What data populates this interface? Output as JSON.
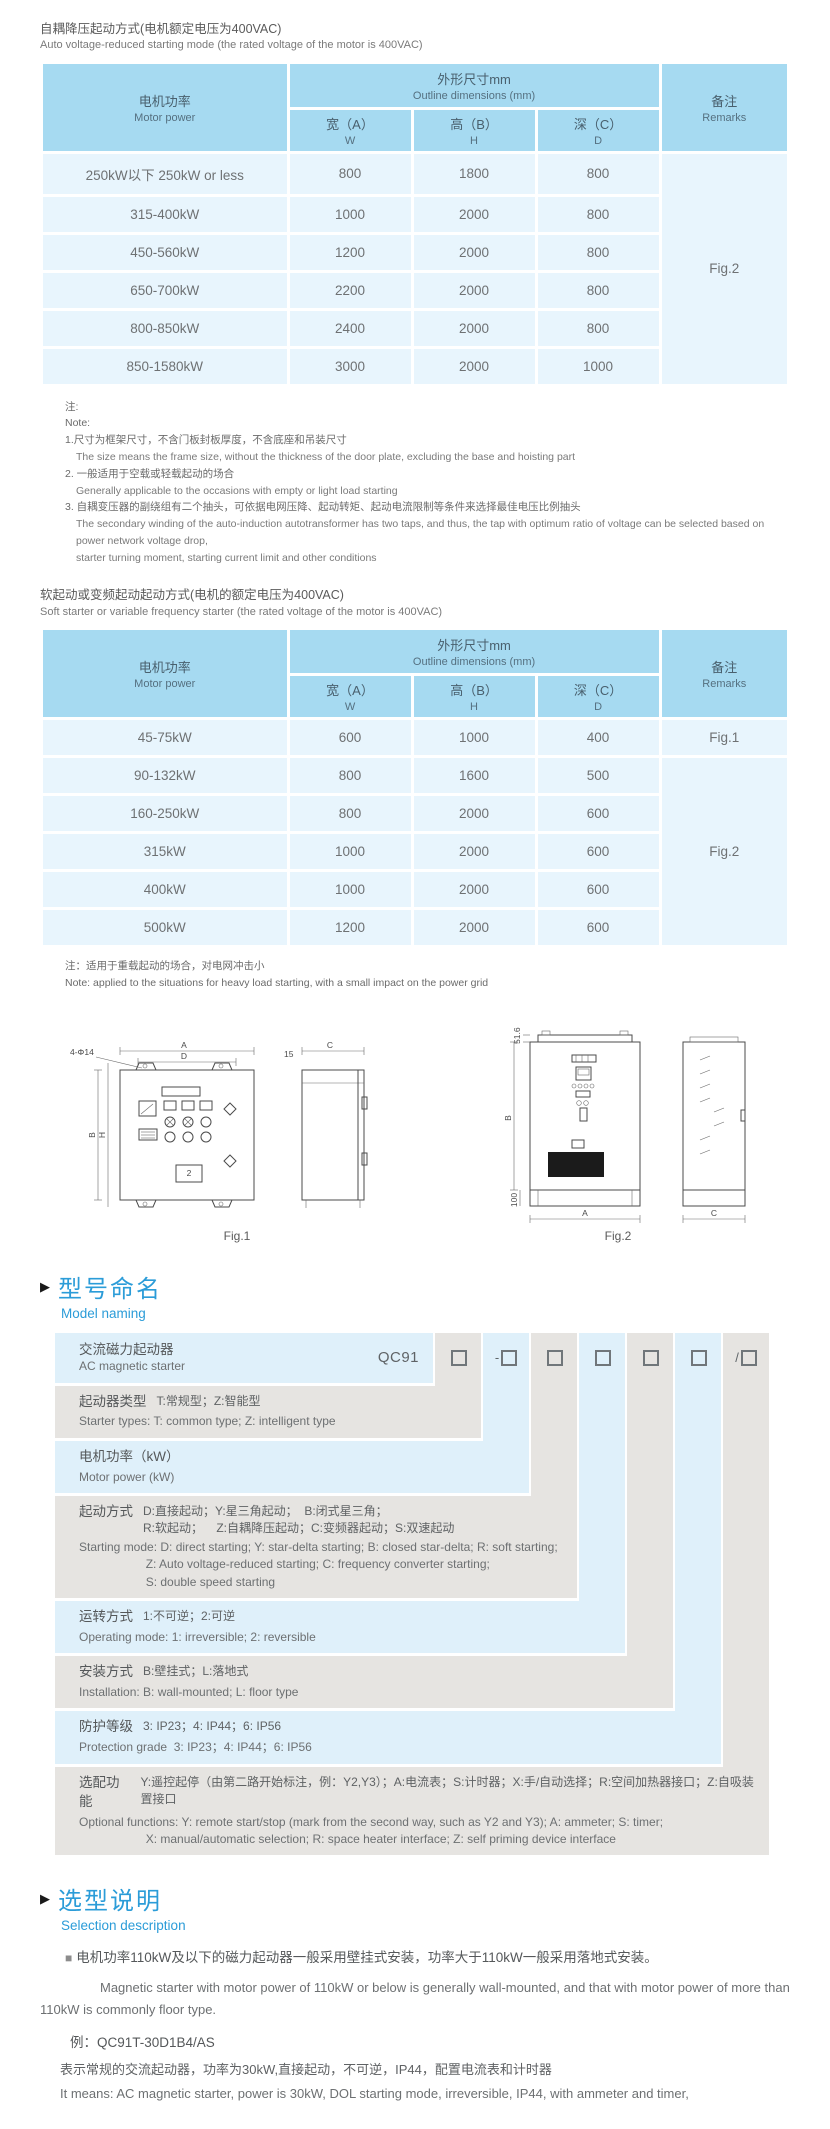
{
  "section1": {
    "title_zh": "自耦降压起动方式(电机额定电压为400VAC)",
    "title_en": "Auto voltage-reduced starting mode (the rated voltage of the motor is 400VAC)"
  },
  "dims_header": {
    "motor_zh": "电机功率",
    "motor_en": "Motor power",
    "outline_zh": "外形尺寸mm",
    "outline_en": "Outline dimensions (mm)",
    "w_zh": "宽（A）",
    "w_en": "W",
    "h_zh": "高（B）",
    "h_en": "H",
    "d_zh": "深（C）",
    "d_en": "D",
    "remarks_zh": "备注",
    "remarks_en": "Remarks"
  },
  "table1": {
    "rows": [
      {
        "power": "250kW以下 250kW or less",
        "w": "800",
        "h": "1800",
        "d": "800",
        "remark": "Fig.2",
        "remark_rowspan": 6
      },
      {
        "power": "315-400kW",
        "w": "1000",
        "h": "2000",
        "d": "800"
      },
      {
        "power": "450-560kW",
        "w": "1200",
        "h": "2000",
        "d": "800"
      },
      {
        "power": "650-700kW",
        "w": "2200",
        "h": "2000",
        "d": "800"
      },
      {
        "power": "800-850kW",
        "w": "2400",
        "h": "2000",
        "d": "800"
      },
      {
        "power": "850-1580kW",
        "w": "3000",
        "h": "2000",
        "d": "1000"
      }
    ]
  },
  "notes1": {
    "lines": [
      "注:",
      "Note:",
      "1.尺寸为框架尺寸，不含门板封板厚度，不含底座和吊装尺寸",
      "The size means the frame size, without the thickness of the door plate, excluding the base and hoisting part",
      "2. 一般适用于空载或轻载起动的场合",
      "Generally applicable to the occasions with empty or light load starting",
      "3. 自耦变压器的副绕组有二个抽头，可依据电网压降、起动转矩、起动电流限制等条件来选择最佳电压比例抽头",
      "The secondary winding of the auto-induction autotransformer has two taps, and thus, the tap with optimum ratio of voltage can be selected based on power network voltage drop,",
      "starter turning moment, starting current limit and other conditions"
    ]
  },
  "section2": {
    "title_zh": "软起动或变频起动起动方式(电机的额定电压为400VAC)",
    "title_en": "Soft starter or variable frequency starter (the rated voltage of the motor is 400VAC)"
  },
  "table2": {
    "rows": [
      {
        "power": "45-75kW",
        "w": "600",
        "h": "1000",
        "d": "400",
        "remark": "Fig.1",
        "remark_rowspan": 1
      },
      {
        "power": "90-132kW",
        "w": "800",
        "h": "1600",
        "d": "500",
        "remark": "Fig.2",
        "remark_rowspan": 5
      },
      {
        "power": "160-250kW",
        "w": "800",
        "h": "2000",
        "d": "600"
      },
      {
        "power": "315kW",
        "w": "1000",
        "h": "2000",
        "d": "600"
      },
      {
        "power": "400kW",
        "w": "1000",
        "h": "2000",
        "d": "600"
      },
      {
        "power": "500kW",
        "w": "1200",
        "h": "2000",
        "d": "600"
      }
    ]
  },
  "note2": {
    "zh": "注：适用于重载起动的场合，对电网冲击小",
    "en": "Note: applied to the situations for heavy load starting, with a small impact on the power grid"
  },
  "figures": {
    "fig1": {
      "label": "Fig.1",
      "labels": {
        "a": "A",
        "d": "D",
        "holes": "4-Φ14",
        "b": "B",
        "h": "H",
        "c": "C",
        "n15": "15",
        "panel2": "2"
      }
    },
    "fig2": {
      "label": "Fig.2",
      "labels": {
        "n516": "51.6",
        "b": "B",
        "n100": "100",
        "a": "A",
        "c": "C"
      }
    }
  },
  "model": {
    "arrow": "▶",
    "title_zh": "型号命名",
    "title_en": "Model naming",
    "starter_zh": "交流磁力起动器",
    "starter_en": "AC magnetic starter",
    "code": "QC91",
    "box_prefixes": [
      "",
      "-",
      "",
      "",
      "",
      "",
      "/"
    ],
    "rows": [
      {
        "zh_label": "起动器类型",
        "zh_desc": "T:常规型；Z:智能型",
        "en": "Starter types: T: common type; Z: intelligent type"
      },
      {
        "zh_label": "电机功率（kW）",
        "zh_desc": "",
        "en": "Motor power (kW)"
      },
      {
        "zh_label": "起动方式",
        "zh_desc": "D:直接起动；Y:星三角起动；  B:闭式星三角；\nR:软起动；    Z:自耦降压起动；C:变频器起动；S:双速起动",
        "en": "Starting mode: D: direct starting; Y: star-delta starting; B: closed star-delta; R: soft starting;\n                    Z: Auto voltage-reduced starting; C: frequency converter starting;\n                    S: double speed starting"
      },
      {
        "zh_label": "运转方式",
        "zh_desc": "1:不可逆；2:可逆",
        "en": "Operating mode: 1: irreversible; 2: reversible"
      },
      {
        "zh_label": "安装方式",
        "zh_desc": "B:壁挂式；L:落地式",
        "en": "Installation: B: wall-mounted; L: floor type"
      },
      {
        "zh_label": "防护等级",
        "zh_desc": "3: IP23；4: IP44；6: IP56",
        "en": "Protection grade  3: IP23；4: IP44；6: IP56"
      },
      {
        "zh_label": "选配功能",
        "zh_desc": "Y:遥控起停（由第二路开始标注，例：Y2,Y3）；A:电流表；S:计时器；X:手/自动选择；R:空间加热器接口；Z:自吸装置接口",
        "en": "Optional functions: Y: remote start/stop (mark from the second way, such as Y2 and Y3); A: ammeter; S: timer;\n                    X: manual/automatic selection; R: space heater interface; Z: self priming device interface"
      }
    ]
  },
  "selection": {
    "arrow": "▶",
    "title_zh": "选型说明",
    "title_en": "Selection description",
    "bullet": "■",
    "p1_zh": "电机功率110kW及以下的磁力起动器一般采用壁挂式安装，功率大于110kW一般采用落地式安装。",
    "p1_en": "Magnetic starter with motor power of 110kW or below is generally wall-mounted, and that with motor power of more than 110kW is commonly floor type.",
    "example": "例：QC91T-30D1B4/AS",
    "ex_zh": "表示常规的交流起动器，功率为30kW,直接起动，不可逆，IP44，配置电流表和计时器",
    "ex_en": "It means: AC magnetic starter, power is 30kW, DOL starting mode, irreversible, IP44, with ammeter and timer,"
  }
}
